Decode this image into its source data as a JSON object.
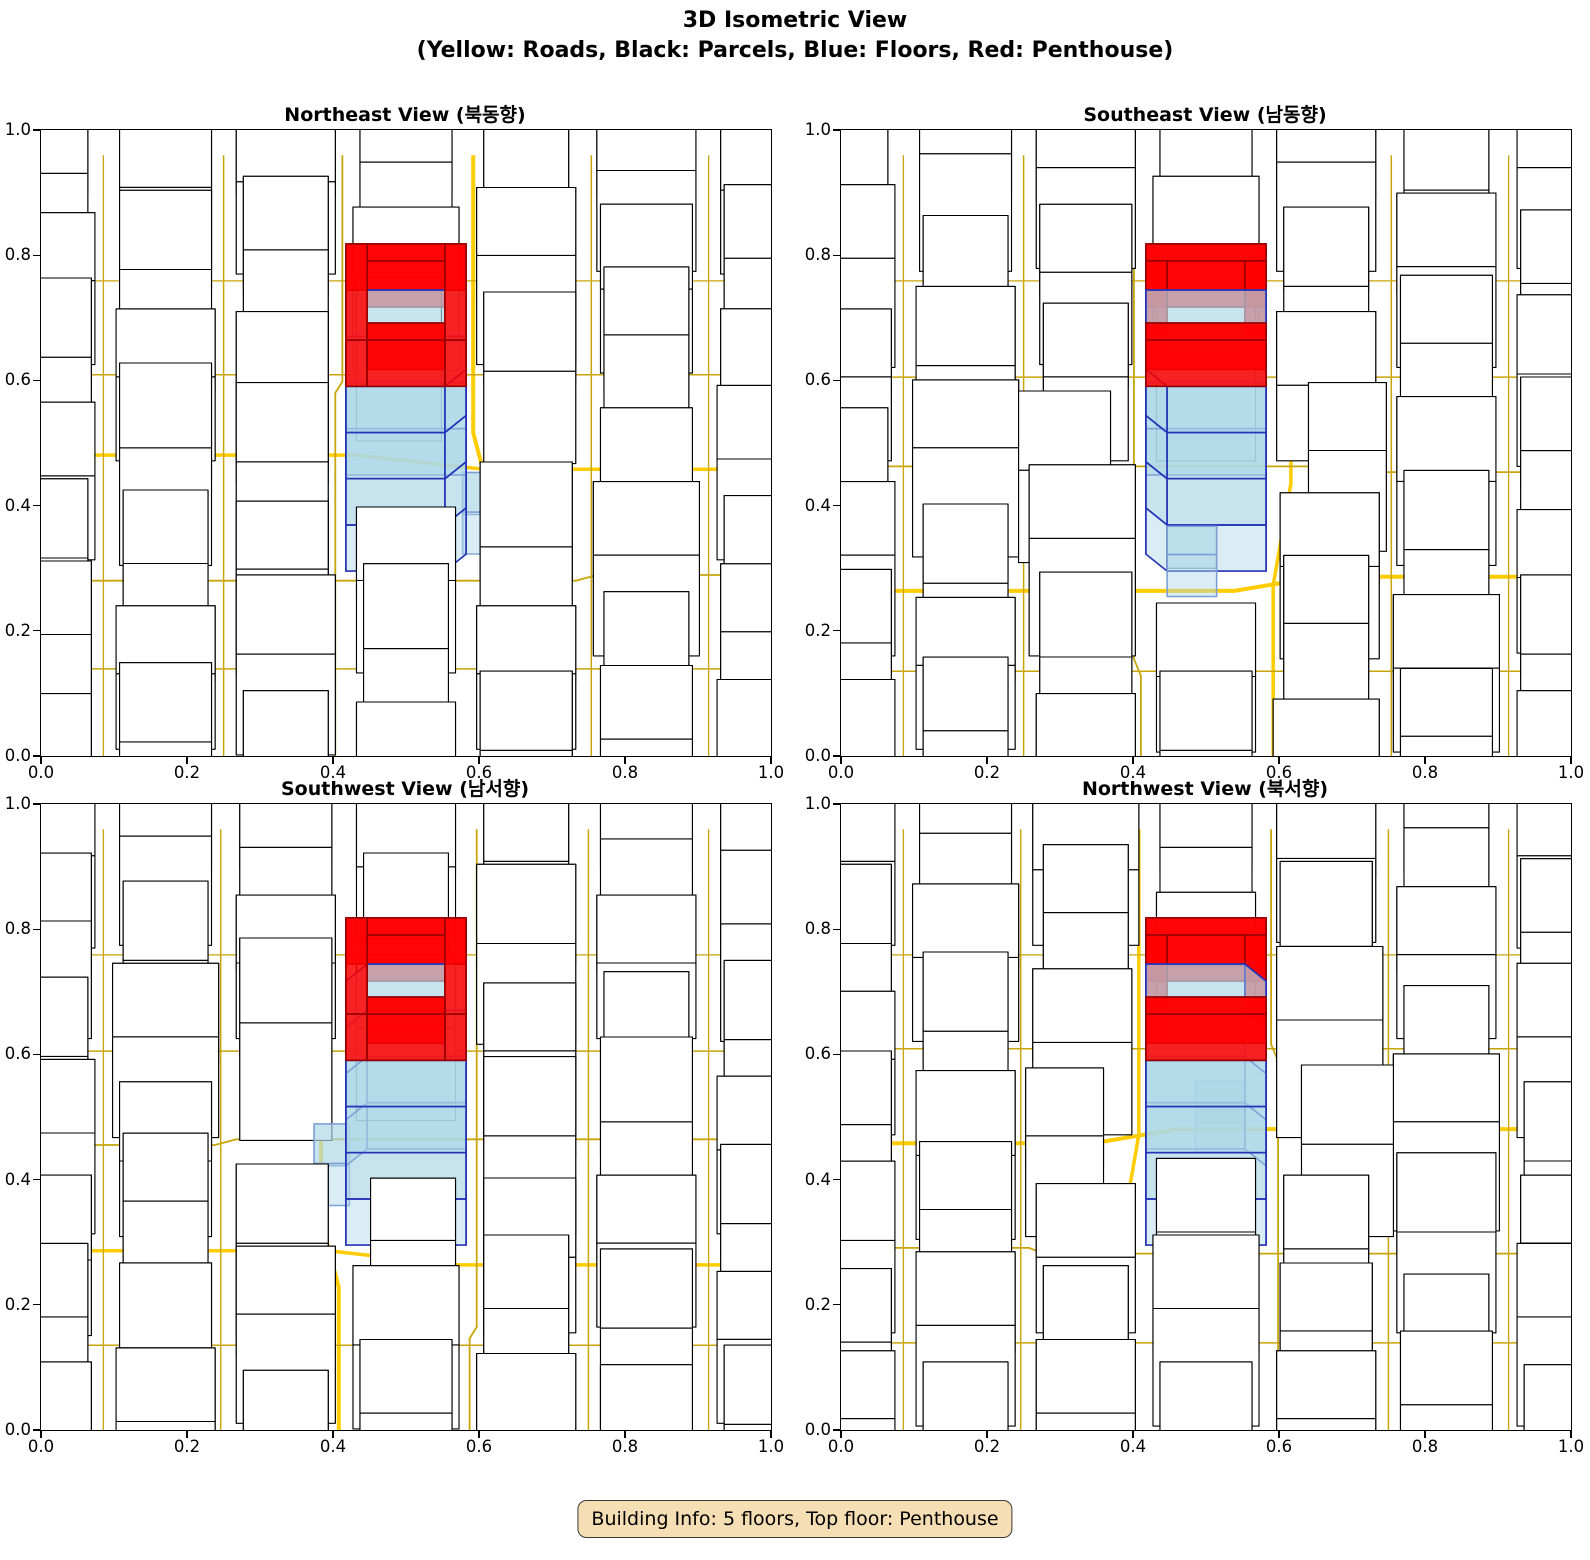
{
  "figure": {
    "title_line1": "3D Isometric View",
    "title_line2": "(Yellow: Roads, Black: Parcels, Blue: Floors, Red: Penthouse)"
  },
  "info_box": {
    "text": "Building Info: 5 floors, Top floor: Penthouse"
  },
  "axes": {
    "ticks": [
      "0.0",
      "0.2",
      "0.4",
      "0.6",
      "0.8",
      "1.0"
    ],
    "range": [
      0,
      1
    ],
    "grid": false
  },
  "colors": {
    "road_major": "#FFCC00",
    "road_minor": "#C8A50A",
    "parcel_fill": "#FFFFFF",
    "parcel_edge": "#000000",
    "floor_fill": "#ADD8E6",
    "floor_edge": "#2433B8",
    "annex_edge": "#7C9FD4",
    "penthouse_fill": "#FF0000",
    "penthouse_edge": "#990000",
    "info_bg": "#F5DEB3",
    "info_border": "#3A3A3A"
  },
  "chart_data": {
    "type": "3d-isometric-city",
    "legend_meaning": {
      "yellow": "Roads",
      "black": "Parcels",
      "blue": "Floors",
      "red": "Penthouse"
    },
    "views": [
      {
        "id": "northeast",
        "title": "Northeast View (북동향)",
        "azimuth_deg": 45
      },
      {
        "id": "southeast",
        "title": "Southeast View (남동향)",
        "azimuth_deg": 135
      },
      {
        "id": "southwest",
        "title": "Southwest View (남서향)",
        "azimuth_deg": 225
      },
      {
        "id": "northwest",
        "title": "Northwest View (북서향)",
        "azimuth_deg": 315
      }
    ],
    "building": {
      "floors": 5,
      "top_floor": "Penthouse",
      "blue_floor_count": 4,
      "footprint": [
        [
          -0.85,
          -0.85
        ],
        [
          0.55,
          -0.85
        ],
        [
          0.85,
          -0.55
        ],
        [
          0.85,
          0.85
        ],
        [
          -0.85,
          0.85
        ]
      ],
      "floor_z": [
        [
          0,
          0.55
        ],
        [
          0.55,
          1.1
        ],
        [
          1.1,
          1.65
        ],
        [
          1.65,
          2.2
        ]
      ],
      "annex": [
        [
          -0.15,
          -1.3
        ],
        [
          0.55,
          -1.3
        ],
        [
          0.55,
          -0.8
        ],
        [
          -0.15,
          -0.8
        ]
      ],
      "annex_z": [
        0,
        0.5
      ],
      "penthouse_z": [
        2.2,
        2.75
      ],
      "penthouse_walls": [
        [
          [
            -0.85,
            0.55
          ],
          [
            0.85,
            0.55
          ],
          [
            0.85,
            0.85
          ],
          [
            -0.85,
            0.85
          ]
        ],
        [
          [
            -0.85,
            -0.85
          ],
          [
            0.85,
            -0.85
          ],
          [
            0.85,
            -0.55
          ],
          [
            -0.85,
            -0.55
          ]
        ],
        [
          [
            -0.85,
            -0.55
          ],
          [
            -0.55,
            -0.55
          ],
          [
            -0.55,
            0.55
          ],
          [
            -0.85,
            0.55
          ]
        ],
        [
          [
            0.55,
            -0.55
          ],
          [
            0.85,
            -0.55
          ],
          [
            0.85,
            0.55
          ],
          [
            0.55,
            0.55
          ]
        ]
      ]
    },
    "parcels_format": "[cx, cy, width, depth, height] in world units",
    "parcels": [
      [
        -5.1,
        -5.1,
        1.4,
        1.3,
        1.0
      ],
      [
        -3.4,
        -5.1,
        1.3,
        1.2,
        1.3
      ],
      [
        -1.7,
        -5.1,
        1.5,
        1.3,
        0.9
      ],
      [
        0,
        -5.1,
        1.3,
        1.4,
        1.2
      ],
      [
        1.7,
        -5.1,
        1.4,
        1.2,
        1.0
      ],
      [
        3.4,
        -5.1,
        1.2,
        1.3,
        1.4
      ],
      [
        5.1,
        -5.1,
        1.4,
        1.4,
        1.1
      ],
      [
        -5.1,
        -3.4,
        1.3,
        1.4,
        1.2
      ],
      [
        -3.4,
        -3.4,
        1.5,
        1.3,
        1.0
      ],
      [
        -1.7,
        -3.4,
        1.2,
        1.2,
        1.5
      ],
      [
        0,
        -3.4,
        1.4,
        1.3,
        0.9
      ],
      [
        1.7,
        -3.4,
        1.3,
        1.5,
        1.2
      ],
      [
        3.4,
        -3.4,
        1.4,
        1.2,
        1.0
      ],
      [
        5.1,
        -3.4,
        1.3,
        1.3,
        1.3
      ],
      [
        -5.1,
        -1.7,
        1.4,
        1.2,
        0.9
      ],
      [
        -3.4,
        -1.7,
        1.2,
        1.4,
        1.3
      ],
      [
        -1.75,
        -1.75,
        1.4,
        1.3,
        1.1
      ],
      [
        1.75,
        -1.7,
        1.5,
        1.3,
        1.4
      ],
      [
        3.4,
        -1.7,
        1.2,
        1.4,
        0.9
      ],
      [
        5.1,
        -1.7,
        1.4,
        1.3,
        1.2
      ],
      [
        -5.1,
        0,
        1.3,
        1.3,
        1.3
      ],
      [
        -3.4,
        0,
        1.4,
        1.5,
        1.0
      ],
      [
        -2.0,
        0.1,
        1.1,
        1.2,
        1.2
      ],
      [
        2.0,
        0,
        1.3,
        1.4,
        1.1
      ],
      [
        3.4,
        0,
        1.5,
        1.2,
        1.3
      ],
      [
        5.1,
        0,
        1.2,
        1.4,
        0.9
      ],
      [
        -5.1,
        1.7,
        1.4,
        1.4,
        1.1
      ],
      [
        -3.4,
        1.7,
        1.3,
        1.2,
        1.4
      ],
      [
        -1.7,
        1.75,
        1.4,
        1.3,
        0.9
      ],
      [
        0,
        1.75,
        1.4,
        1.3,
        1.2
      ],
      [
        1.7,
        1.75,
        1.2,
        1.3,
        1.0
      ],
      [
        3.4,
        1.7,
        1.4,
        1.4,
        1.2
      ],
      [
        5.1,
        1.7,
        1.3,
        1.2,
        1.0
      ],
      [
        -5.1,
        3.4,
        1.3,
        1.3,
        1.0
      ],
      [
        -3.4,
        3.4,
        1.4,
        1.3,
        1.2
      ],
      [
        -1.7,
        3.4,
        1.2,
        1.4,
        1.0
      ],
      [
        0,
        3.4,
        1.5,
        1.3,
        1.4
      ],
      [
        1.7,
        3.4,
        1.3,
        1.2,
        1.1
      ],
      [
        3.4,
        3.4,
        1.2,
        1.4,
        0.9
      ],
      [
        5.1,
        3.4,
        1.4,
        1.3,
        1.3
      ],
      [
        -5.1,
        5.1,
        1.4,
        1.2,
        1.2
      ],
      [
        -3.4,
        5.1,
        1.2,
        1.4,
        1.0
      ],
      [
        -1.7,
        5.1,
        1.4,
        1.3,
        1.3
      ],
      [
        0,
        5.1,
        1.3,
        1.4,
        1.0
      ],
      [
        1.7,
        5.1,
        1.4,
        1.2,
        1.2
      ],
      [
        3.4,
        5.1,
        1.3,
        1.3,
        1.4
      ],
      [
        5.1,
        5.1,
        1.2,
        1.3,
        1.0
      ]
    ],
    "roads": [
      {
        "kind": "major",
        "width": 4,
        "pts": [
          [
            -6.5,
            -0.95
          ],
          [
            -1.6,
            -0.95
          ],
          [
            -0.4,
            -1.2
          ],
          [
            6.5,
            -1.2
          ]
        ]
      },
      {
        "kind": "major",
        "width": 3.5,
        "pts": [
          [
            -0.95,
            -6.5
          ],
          [
            -0.95,
            -1.1
          ],
          [
            -1.2,
            0.7
          ],
          [
            -1.2,
            6.5
          ]
        ]
      },
      {
        "kind": "minor",
        "width": 1.8,
        "pts": [
          [
            -6.5,
            0.9
          ],
          [
            -2.5,
            0.9
          ],
          [
            -2.3,
            1.0
          ],
          [
            6.5,
            1.0
          ]
        ]
      },
      {
        "kind": "minor",
        "width": 1.8,
        "pts": [
          [
            0.92,
            -6.5
          ],
          [
            0.92,
            -2.7
          ],
          [
            1.02,
            -2.4
          ],
          [
            1.02,
            6.5
          ]
        ]
      },
      {
        "kind": "minor",
        "width": 1.5,
        "pts": [
          [
            -6.5,
            2.58
          ],
          [
            6.5,
            2.58
          ]
        ]
      },
      {
        "kind": "minor",
        "width": 1.5,
        "pts": [
          [
            2.58,
            -6.5
          ],
          [
            2.58,
            6.5
          ]
        ]
      },
      {
        "kind": "minor",
        "width": 1.5,
        "pts": [
          [
            -6.5,
            -2.62
          ],
          [
            6.5,
            -2.62
          ]
        ]
      },
      {
        "kind": "minor",
        "width": 1.5,
        "pts": [
          [
            -2.62,
            -6.5
          ],
          [
            -2.62,
            6.5
          ]
        ]
      },
      {
        "kind": "minor",
        "width": 1.3,
        "pts": [
          [
            -6.5,
            4.28
          ],
          [
            6.5,
            4.28
          ]
        ]
      },
      {
        "kind": "minor",
        "width": 1.3,
        "pts": [
          [
            4.28,
            -6.5
          ],
          [
            4.28,
            6.5
          ]
        ]
      },
      {
        "kind": "minor",
        "width": 1.3,
        "pts": [
          [
            -4.28,
            -6.5
          ],
          [
            -4.28,
            6.5
          ]
        ]
      },
      {
        "kind": "minor",
        "width": 1.3,
        "pts": [
          [
            -6.5,
            -4.28
          ],
          [
            6.5,
            -4.28
          ]
        ]
      }
    ]
  }
}
